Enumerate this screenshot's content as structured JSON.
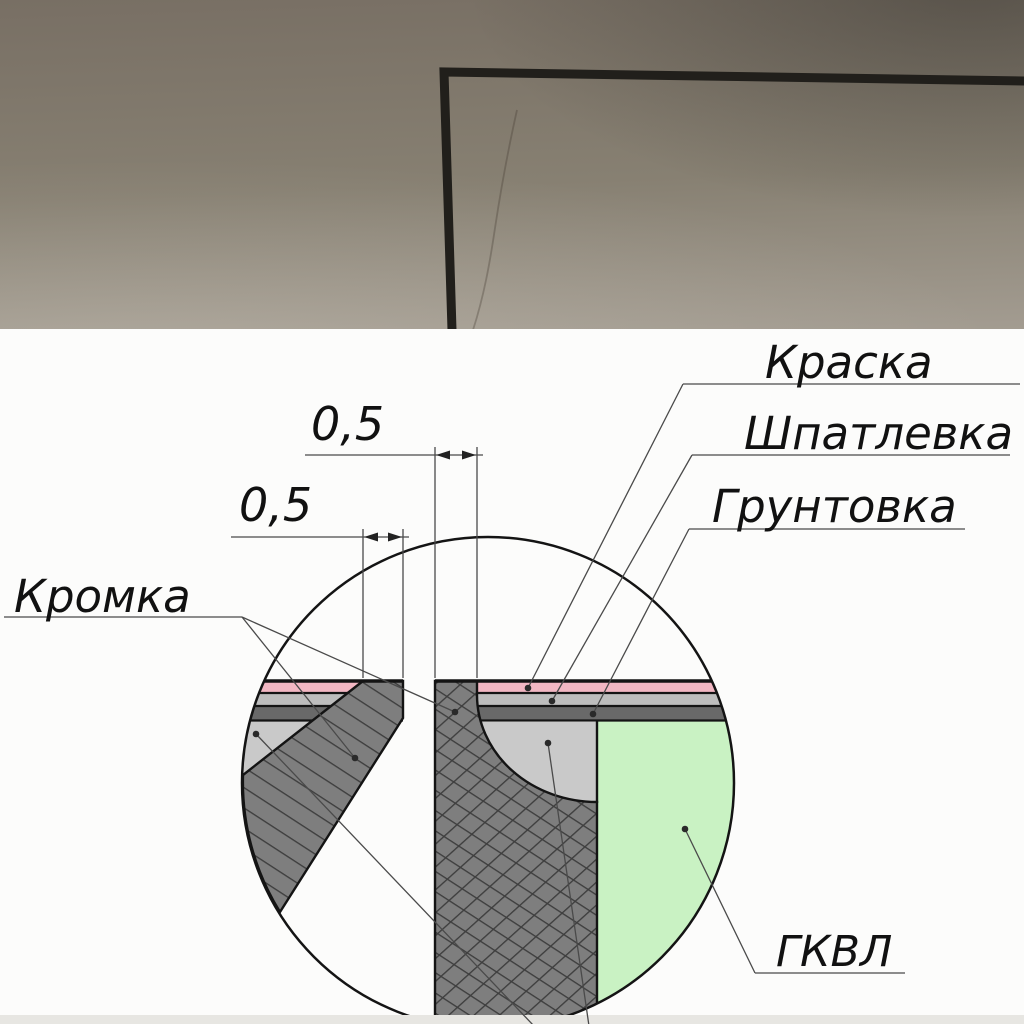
{
  "photo": {
    "wall_color_top": "#786f64",
    "wall_color_bottom": "#a39c91",
    "corner_line_color": "#211f1b"
  },
  "drawing": {
    "labels": {
      "paint": "Краска",
      "putty": "Шпатлевка",
      "primer": "Грунтовка",
      "edge": "Кромка",
      "board": "ГКВЛ"
    },
    "dimensions": {
      "gap": "0,5",
      "edge": "0,5"
    },
    "colors": {
      "paint": "#f2b7c3",
      "putty": "#bdbdbd",
      "primer": "#696969",
      "board": "#c9f2c3",
      "filler": "#c9c9c9",
      "core": "#7e7e7e",
      "outline": "#141414"
    }
  }
}
